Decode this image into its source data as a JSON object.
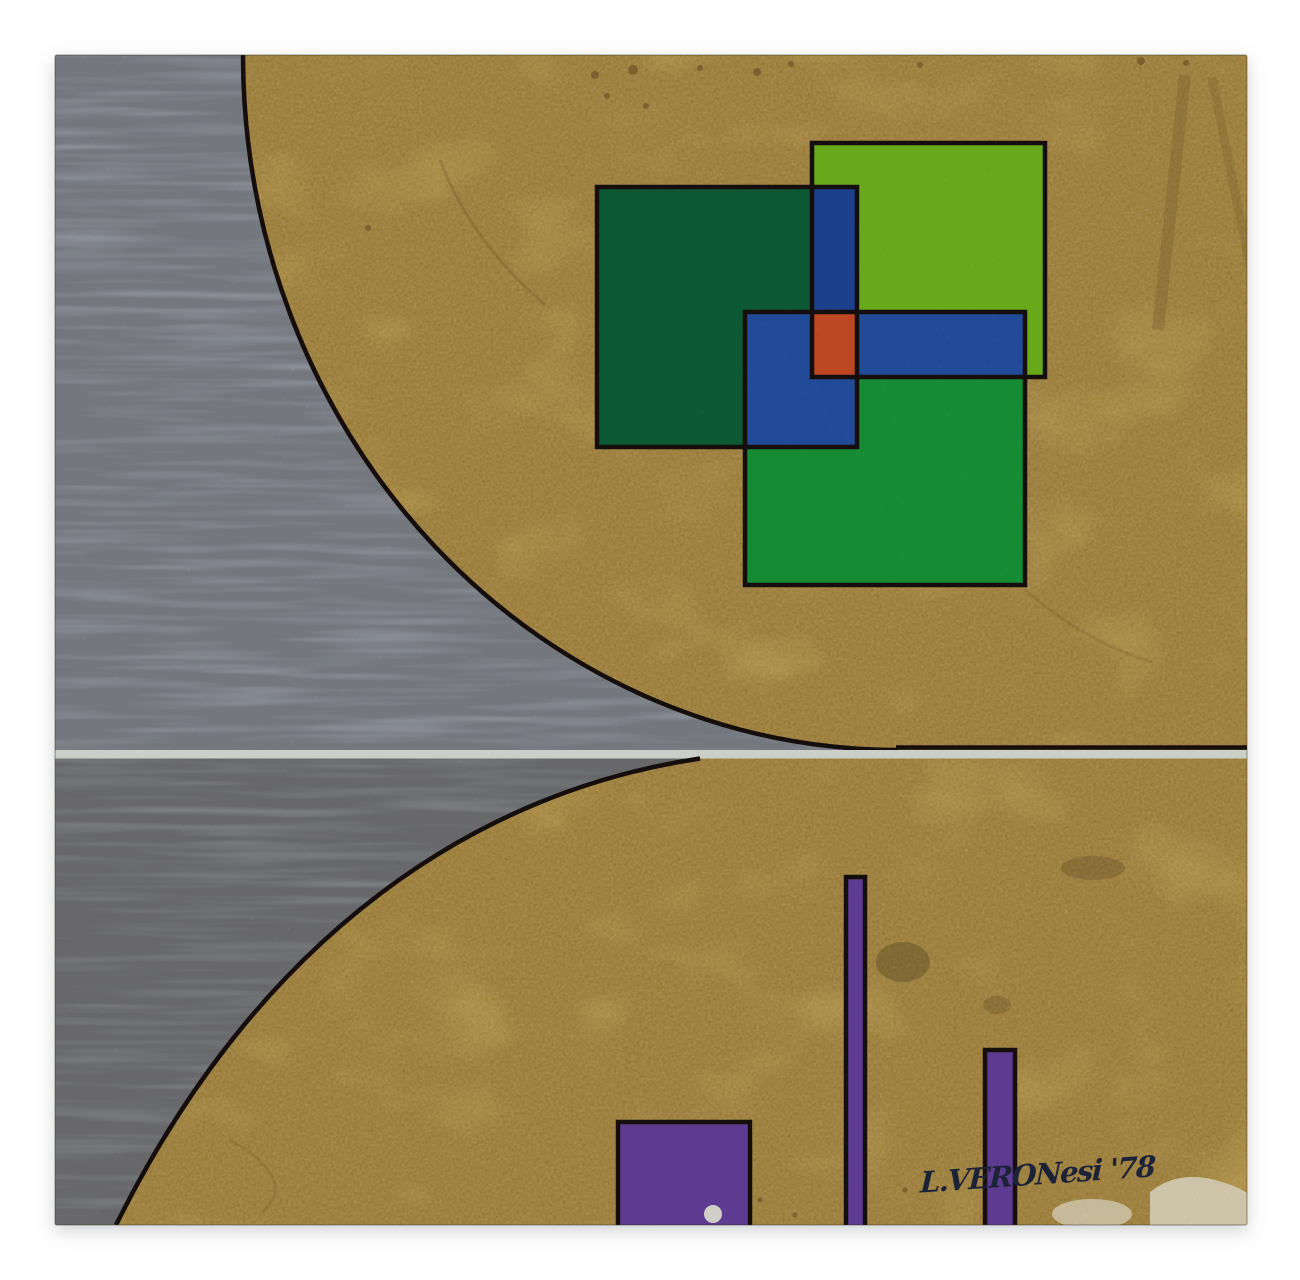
{
  "artwork": {
    "signature_text": "L.VERONesi '78",
    "year_shown": "78"
  },
  "palette": {
    "backdrop": "#ffffff",
    "gold": "#d2ab4d",
    "gold_bright": "#e8cc74",
    "gold_shade": "#b08a38",
    "gray_top": "#b7bdc7",
    "gray_bottom": "#a7aaa9",
    "white_line": "#eef0e9",
    "outline": "#16120c",
    "dark_green": "#0e683d",
    "light_green": "#79c522",
    "mid_green": "#16a23c",
    "blue_strip": "#2349a2",
    "blue": "#2a58b0",
    "red": "#dc5129",
    "purple": "#6a44a9",
    "ink": "#1d2438",
    "stain_light": "#f2e8cc",
    "speck_brown": "#7a5a28"
  }
}
